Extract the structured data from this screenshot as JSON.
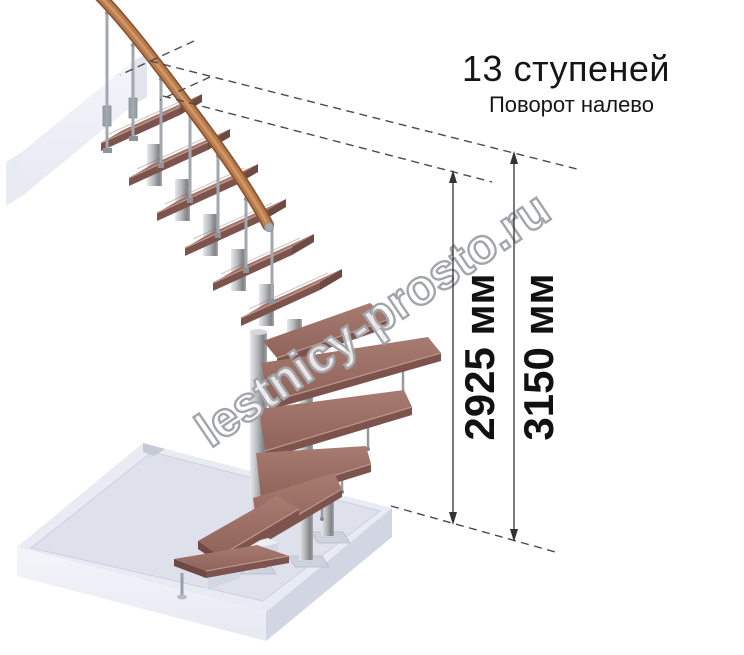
{
  "illustration": {
    "title": "13 ступеней",
    "subtitle": "Поворот налево",
    "watermark": "lestnicy-prosto.ru",
    "dimensions": {
      "inner": "2925 мм",
      "outer": "3150 мм"
    },
    "colors": {
      "wood_top": "#9d7066",
      "wood_edge": "#7c544d",
      "handrail": "#b97a4c",
      "metal": "#a9adb2",
      "floor_slab": "#e0e2ed",
      "dashed_line": "#4b4b4b",
      "dimension_line": "#333333",
      "text": "#161616"
    }
  }
}
